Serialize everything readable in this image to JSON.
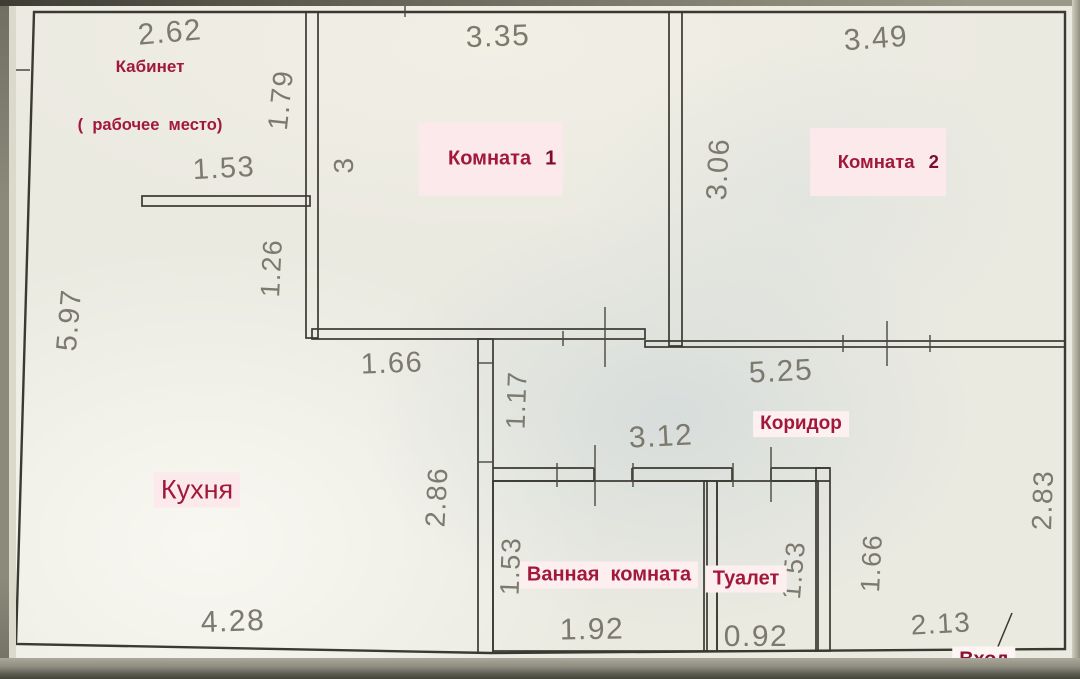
{
  "rooms": {
    "kabinet": {
      "label": "Кабинет",
      "sublabel": "(  рабочее  место)"
    },
    "komnata1": {
      "label": "Комната",
      "number": "1"
    },
    "komnata2": {
      "label": "Комната",
      "number": "2"
    },
    "kuhnya": {
      "label": "Кухня"
    },
    "koridor": {
      "label": "Коридор"
    },
    "vannaya": {
      "label": "Ванная  комната"
    },
    "tualet": {
      "label": "Туалет"
    },
    "vhod": {
      "label": "Вход"
    }
  },
  "dims": {
    "kabinet_top": "2.62",
    "kabinet_right": "1.79",
    "kabinet_partition": "1.53",
    "komnata1_top": "3.35",
    "komnata1_left": "3",
    "komnata2_top": "3.49",
    "komnata2_left": "3.06",
    "wall_126": "1.26",
    "left_wall": "5.97",
    "kitchen_top": "1.66",
    "kitchen_right": "2.86",
    "kitchen_bottom": "4.28",
    "koridor_left": "1.17",
    "koridor_top": "5.25",
    "koridor_width": "3.12",
    "vannaya_left": "1.53",
    "vannaya_bottom": "1.92",
    "tualet_right": "1.53",
    "tualet_bottom": "0.92",
    "entry_left": "1.66",
    "entry_right": "2.83",
    "entry_bottom": "2.13"
  },
  "colors": {
    "wall": "#3b3931",
    "dim_text": "#7c796e",
    "room_text": "#a2183a",
    "room_highlight": "#fbe9ec"
  }
}
